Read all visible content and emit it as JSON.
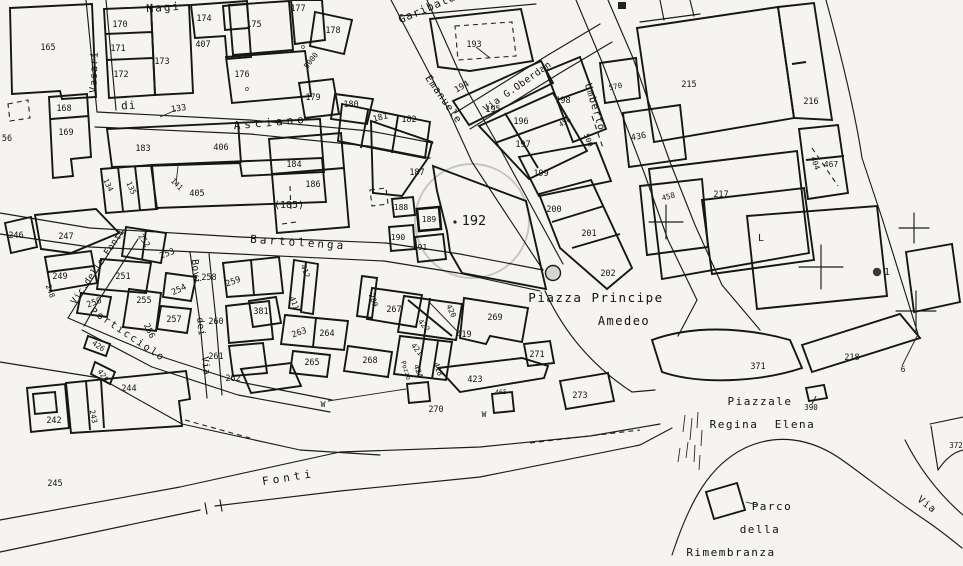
{
  "map": {
    "kind": "cadastral-town-plan",
    "highlighted_parcel": "192",
    "colors": {
      "paper": "#f5f4f1",
      "line": "#1c1c1c",
      "highlight_circle": "#c7c6c3"
    },
    "labels": {
      "streets": [
        {
          "t": "Magi",
          "x": 164,
          "y": 11,
          "r": -4,
          "s": 11,
          "ls": 2
        },
        {
          "t": "Vasari",
          "x": 97,
          "y": 72,
          "r": -88,
          "s": 10,
          "ls": 1
        },
        {
          "t": "di",
          "x": 129,
          "y": 109,
          "r": -4,
          "s": 11,
          "ls": 1
        },
        {
          "t": "Asciano",
          "x": 271,
          "y": 126,
          "r": -5,
          "s": 11,
          "ls": 4
        },
        {
          "t": "Garibaldi",
          "x": 432,
          "y": 10,
          "r": -23,
          "s": 11,
          "ls": 1
        },
        {
          "t": "Emanuele",
          "x": 441,
          "y": 101,
          "r": 55,
          "s": 10,
          "ls": 1
        },
        {
          "t": "Via  G.Oberdan",
          "x": 519,
          "y": 89,
          "r": -35,
          "s": 9.5,
          "ls": 0.5
        },
        {
          "t": "Umberto",
          "x": 592,
          "y": 108,
          "r": 73,
          "s": 10,
          "ls": 1
        },
        {
          "t": "Bartolenga",
          "x": 298,
          "y": 246,
          "r": 4,
          "s": 11,
          "ls": 3
        },
        {
          "t": "Vic.delle Fonti",
          "x": 100,
          "y": 268,
          "r": -56,
          "s": 9,
          "ls": 0.5
        },
        {
          "t": "Porticciolo",
          "x": 126,
          "y": 337,
          "r": 34,
          "s": 10,
          "ls": 2
        },
        {
          "t": "Bovi",
          "x": 193,
          "y": 272,
          "r": 84,
          "s": 9.5,
          "ls": 0.5
        },
        {
          "t": "dei",
          "x": 198,
          "y": 327,
          "r": 84,
          "s": 9.5,
          "ls": 0.5
        },
        {
          "t": "Via",
          "x": 203,
          "y": 366,
          "r": 84,
          "s": 9.5,
          "ls": 0.5
        },
        {
          "t": "Fonti",
          "x": 289,
          "y": 481,
          "r": -9,
          "s": 11,
          "ls": 4
        },
        {
          "t": "Piazza Principe",
          "x": 596,
          "y": 302,
          "r": 0,
          "s": 12.5,
          "ls": 1.5
        },
        {
          "t": "Amedeo",
          "x": 624,
          "y": 325,
          "r": 0,
          "s": 12,
          "ls": 1.5
        },
        {
          "t": "Piazzale",
          "x": 760,
          "y": 405,
          "r": 0,
          "s": 11,
          "ls": 1.5
        },
        {
          "t": "Regina",
          "x": 734,
          "y": 428,
          "r": 0,
          "s": 11,
          "ls": 1.5
        },
        {
          "t": "Elena",
          "x": 795,
          "y": 428,
          "r": 0,
          "s": 11,
          "ls": 1.5
        },
        {
          "t": "Parco",
          "x": 772,
          "y": 510,
          "r": 0,
          "s": 11,
          "ls": 1.5
        },
        {
          "t": "della",
          "x": 760,
          "y": 533,
          "r": 0,
          "s": 11,
          "ls": 1.5
        },
        {
          "t": "Rimembranza",
          "x": 731,
          "y": 556,
          "r": 0,
          "s": 11,
          "ls": 1.5
        },
        {
          "t": "Via",
          "x": 925,
          "y": 507,
          "r": 38,
          "s": 10,
          "ls": 1
        }
      ],
      "parcels": [
        {
          "t": "165",
          "x": 48,
          "y": 50
        },
        {
          "t": "170",
          "x": 120,
          "y": 27
        },
        {
          "t": "171",
          "x": 118,
          "y": 51
        },
        {
          "t": "172",
          "x": 121,
          "y": 77
        },
        {
          "t": "173",
          "x": 162,
          "y": 64
        },
        {
          "t": "174",
          "x": 204,
          "y": 21
        },
        {
          "t": "407",
          "x": 203,
          "y": 47
        },
        {
          "t": "175",
          "x": 254,
          "y": 27
        },
        {
          "t": "177",
          "x": 298,
          "y": 11
        },
        {
          "t": "178",
          "x": 333,
          "y": 33
        },
        {
          "t": "176",
          "x": 242,
          "y": 77
        },
        {
          "t": "179",
          "x": 313,
          "y": 100
        },
        {
          "t": "180",
          "x": 351,
          "y": 107
        },
        {
          "t": "181",
          "x": 381,
          "y": 120,
          "r": -15
        },
        {
          "t": "182",
          "x": 409,
          "y": 122
        },
        {
          "t": "5000",
          "x": 313,
          "y": 62,
          "r": -52,
          "s": 7.5
        },
        {
          "t": "56",
          "x": 7,
          "y": 141
        },
        {
          "t": "168",
          "x": 64,
          "y": 111
        },
        {
          "t": "169",
          "x": 66,
          "y": 135
        },
        {
          "t": "133",
          "x": 179,
          "y": 111,
          "r": -8
        },
        {
          "t": "183",
          "x": 143,
          "y": 151
        },
        {
          "t": "406",
          "x": 221,
          "y": 150
        },
        {
          "t": "405",
          "x": 197,
          "y": 196
        },
        {
          "t": "134",
          "x": 106,
          "y": 186,
          "r": 65,
          "s": 7.5
        },
        {
          "t": "135",
          "x": 129,
          "y": 189,
          "r": 65,
          "s": 7.5
        },
        {
          "t": "141",
          "x": 175,
          "y": 186,
          "r": 45,
          "s": 7.5
        },
        {
          "t": "184",
          "x": 294,
          "y": 167
        },
        {
          "t": "186",
          "x": 313,
          "y": 187
        },
        {
          "t": "(185)",
          "x": 289,
          "y": 208,
          "s": 10
        },
        {
          "t": "187",
          "x": 417,
          "y": 175
        },
        {
          "t": "188",
          "x": 401,
          "y": 210,
          "s": 8
        },
        {
          "t": "189",
          "x": 429,
          "y": 222,
          "s": 8
        },
        {
          "t": "190",
          "x": 398,
          "y": 240,
          "s": 8
        },
        {
          "t": "191",
          "x": 420,
          "y": 250,
          "s": 8
        },
        {
          "t": "192",
          "x": 474,
          "y": 225,
          "s": 13.5
        },
        {
          "t": "193",
          "x": 474,
          "y": 47
        },
        {
          "t": "194",
          "x": 463,
          "y": 89,
          "r": -30
        },
        {
          "t": "195",
          "x": 493,
          "y": 112
        },
        {
          "t": "196",
          "x": 521,
          "y": 124
        },
        {
          "t": "197",
          "x": 523,
          "y": 147
        },
        {
          "t": "198",
          "x": 563,
          "y": 103
        },
        {
          "t": "456",
          "x": 566,
          "y": 124,
          "r": -30,
          "s": 7
        },
        {
          "t": "500",
          "x": 586,
          "y": 141,
          "r": 70,
          "s": 7.5
        },
        {
          "t": "199",
          "x": 541,
          "y": 176
        },
        {
          "t": "200",
          "x": 554,
          "y": 212
        },
        {
          "t": "201",
          "x": 589,
          "y": 236
        },
        {
          "t": "202",
          "x": 608,
          "y": 276
        },
        {
          "t": "570",
          "x": 616,
          "y": 89,
          "r": -12,
          "s": 7.5
        },
        {
          "t": "215",
          "x": 689,
          "y": 87
        },
        {
          "t": "216",
          "x": 811,
          "y": 104
        },
        {
          "t": "436",
          "x": 639,
          "y": 139,
          "r": -10
        },
        {
          "t": "404",
          "x": 813,
          "y": 164,
          "r": 70,
          "s": 7.5
        },
        {
          "t": "467",
          "x": 831,
          "y": 167,
          "s": 8
        },
        {
          "t": "458",
          "x": 669,
          "y": 199,
          "r": -15,
          "s": 7.5
        },
        {
          "t": "217",
          "x": 721,
          "y": 197
        },
        {
          "t": "371",
          "x": 758,
          "y": 369
        },
        {
          "t": "218",
          "x": 852,
          "y": 360
        },
        {
          "t": "390",
          "x": 811,
          "y": 410,
          "s": 7.5
        },
        {
          "t": "372",
          "x": 956,
          "y": 448,
          "s": 7.5
        },
        {
          "t": "246",
          "x": 16,
          "y": 238
        },
        {
          "t": "247",
          "x": 66,
          "y": 239
        },
        {
          "t": "249",
          "x": 60,
          "y": 279
        },
        {
          "t": "248",
          "x": 48,
          "y": 292,
          "r": 70,
          "s": 7.5
        },
        {
          "t": "252",
          "x": 142,
          "y": 242,
          "r": 55,
          "s": 8
        },
        {
          "t": "253",
          "x": 168,
          "y": 256,
          "r": -20
        },
        {
          "t": "251",
          "x": 123,
          "y": 279
        },
        {
          "t": "254",
          "x": 180,
          "y": 292,
          "r": -25
        },
        {
          "t": "250",
          "x": 95,
          "y": 305,
          "r": -20
        },
        {
          "t": "255",
          "x": 144,
          "y": 303
        },
        {
          "t": "256",
          "x": 147,
          "y": 332,
          "r": 65
        },
        {
          "t": "257",
          "x": 174,
          "y": 322
        },
        {
          "t": "258",
          "x": 209,
          "y": 280
        },
        {
          "t": "259",
          "x": 234,
          "y": 284,
          "r": -20
        },
        {
          "t": "260",
          "x": 216,
          "y": 324
        },
        {
          "t": "261",
          "x": 216,
          "y": 359
        },
        {
          "t": "262",
          "x": 233,
          "y": 381
        },
        {
          "t": "381",
          "x": 261,
          "y": 314
        },
        {
          "t": "426",
          "x": 97,
          "y": 348,
          "r": 35,
          "s": 7.5
        },
        {
          "t": "425",
          "x": 101,
          "y": 377,
          "r": 55,
          "s": 7.5
        },
        {
          "t": "244",
          "x": 129,
          "y": 391
        },
        {
          "t": "243",
          "x": 91,
          "y": 417,
          "r": 78,
          "s": 7.5
        },
        {
          "t": "242",
          "x": 54,
          "y": 423
        },
        {
          "t": "245",
          "x": 55,
          "y": 486
        },
        {
          "t": "263",
          "x": 300,
          "y": 335,
          "r": -20
        },
        {
          "t": "264",
          "x": 327,
          "y": 336
        },
        {
          "t": "265",
          "x": 312,
          "y": 365
        },
        {
          "t": "268",
          "x": 370,
          "y": 363
        },
        {
          "t": "267",
          "x": 394,
          "y": 312
        },
        {
          "t": "280",
          "x": 371,
          "y": 301,
          "r": 70,
          "s": 7.5
        },
        {
          "t": "412",
          "x": 303,
          "y": 272,
          "r": 70,
          "s": 7.5
        },
        {
          "t": "411",
          "x": 292,
          "y": 304,
          "r": 70,
          "s": 7.5
        },
        {
          "t": "269",
          "x": 495,
          "y": 320
        },
        {
          "t": "419",
          "x": 464,
          "y": 337
        },
        {
          "t": "420",
          "x": 449,
          "y": 312,
          "r": 65,
          "s": 7.5
        },
        {
          "t": "422",
          "x": 422,
          "y": 327,
          "r": 50,
          "s": 7.5
        },
        {
          "t": "421",
          "x": 415,
          "y": 351,
          "r": 50,
          "s": 7.5
        },
        {
          "t": "418",
          "x": 436,
          "y": 370,
          "r": 70,
          "s": 7.5
        },
        {
          "t": "424",
          "x": 416,
          "y": 372,
          "r": 70,
          "s": 7.5
        },
        {
          "t": "Pozzo",
          "x": 404,
          "y": 371,
          "r": 72,
          "s": 6.5
        },
        {
          "t": "423",
          "x": 475,
          "y": 382
        },
        {
          "t": "270",
          "x": 436,
          "y": 412
        },
        {
          "t": "271",
          "x": 537,
          "y": 357
        },
        {
          "t": "273",
          "x": 580,
          "y": 398
        },
        {
          "t": "465",
          "x": 501,
          "y": 394,
          "s": 6.5
        }
      ],
      "symbols": [
        {
          "t": "W",
          "x": 323,
          "y": 407,
          "s": 8
        },
        {
          "t": "W",
          "x": 484,
          "y": 417,
          "s": 8
        },
        {
          "t": "L",
          "x": 761,
          "y": 241,
          "s": 10
        },
        {
          "t": "1",
          "x": 887,
          "y": 275,
          "s": 9.5
        },
        {
          "t": "6",
          "x": 903,
          "y": 372,
          "s": 8
        },
        {
          "t": "o",
          "x": 247,
          "y": 91,
          "s": 7
        },
        {
          "t": "o",
          "x": 303,
          "y": 49,
          "s": 7
        }
      ]
    }
  }
}
